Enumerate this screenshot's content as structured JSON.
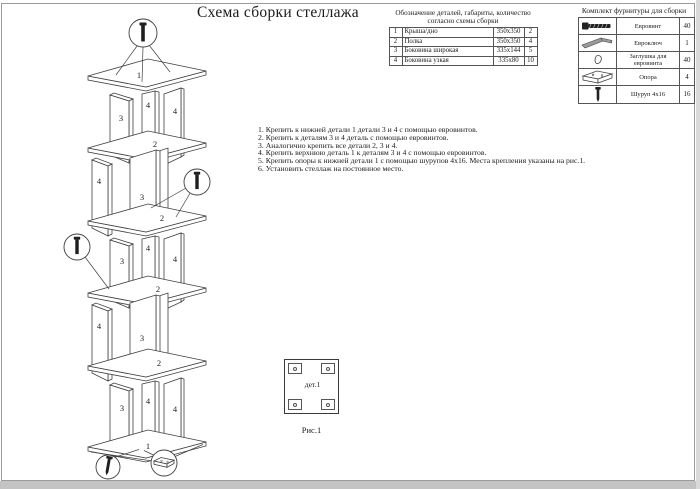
{
  "page": {
    "title": "Схема сборки стеллажа"
  },
  "parts_table": {
    "title_line1": "Обозначение деталей, габариты, количество",
    "title_line2": "согласно схемы сборки",
    "rows": [
      {
        "num": "1",
        "name": "Крыша/дно",
        "size": "350х350",
        "qty": "2"
      },
      {
        "num": "2",
        "name": "Полка",
        "size": "350х350",
        "qty": "4"
      },
      {
        "num": "3",
        "name": "Боковина широкая",
        "size": "335х144",
        "qty": "5"
      },
      {
        "num": "4",
        "name": "Боковина узкая",
        "size": "335х80",
        "qty": "10"
      }
    ]
  },
  "hardware_table": {
    "title": "Комплект фурнитуры для сборки",
    "rows": [
      {
        "icon": "euroscrew-icon",
        "name": "Евровинт",
        "qty": "40"
      },
      {
        "icon": "hexkey-icon",
        "name": "Евроключ",
        "qty": "1"
      },
      {
        "icon": "cap-icon",
        "name": "Заглушка для евровинта",
        "qty": "40"
      },
      {
        "icon": "support-icon",
        "name": "Опора",
        "qty": "4"
      },
      {
        "icon": "screw-icon",
        "name": "Шуруп 4х16",
        "qty": "16"
      }
    ]
  },
  "instructions": [
    "1. Крепить к нижней детали 1 детали 3 и 4 с помощью евровинтов.",
    "2. Крепить к деталям 3 и 4 деталь с помощью евровинтов.",
    "3. Аналогично крепить все детали 2, 3 и 4.",
    "4. Крепить верхнюю деталь 1 к деталям 3 и 4 с помощью евровинтов.",
    "5. Крепить опоры к нижней детали 1 с помощью шурупов 4х16. Места крепления указаны на рис.1.",
    "6. Установить стеллаж на постоянное место."
  ],
  "figure1": {
    "label": "дет.1",
    "caption": "Рис.1"
  },
  "diagram": {
    "labels": [
      "1",
      "3",
      "4",
      "4",
      "2",
      "4",
      "3",
      "2",
      "3",
      "4",
      "4",
      "2",
      "4",
      "3",
      "2",
      "3",
      "4",
      "4",
      "1"
    ]
  },
  "colors": {
    "ink": "#3f3f3f",
    "paper": "#ffffff",
    "edge_band": "#c3c3c3"
  }
}
